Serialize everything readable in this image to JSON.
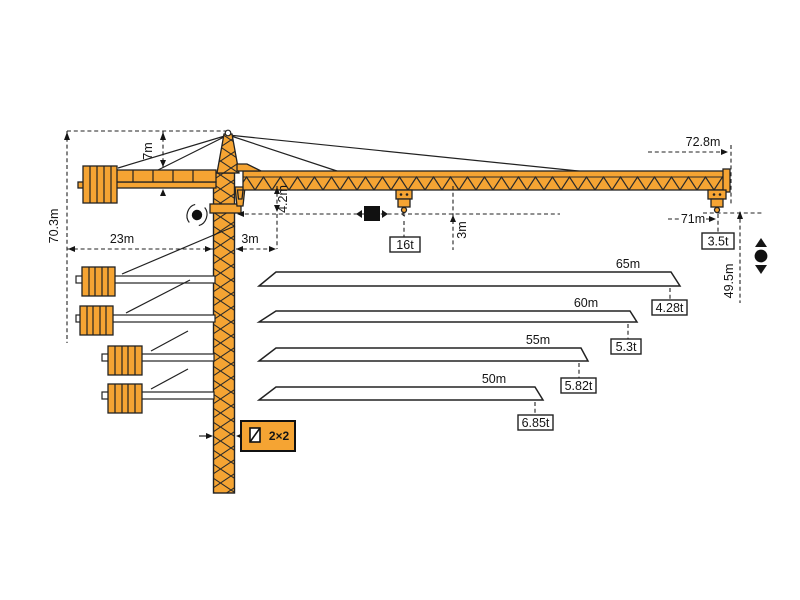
{
  "diagram": {
    "type": "tower-crane-specification-drawing",
    "colors": {
      "crane_orange": "#F5A433",
      "line_black": "#222222",
      "background": "#ffffff"
    },
    "dims": {
      "total_height": "70.3m",
      "head_height": "7m",
      "counterjib_radius": "23m",
      "slew_offset": "3m",
      "jib_depth": "4.2m",
      "hook_drop": "3m",
      "max_capacity": "16t",
      "jib_length_overall": "72.8m",
      "max_hook_radius": "71m",
      "tip_capacity": "3.5t",
      "hook_height": "49.5m",
      "mast_section": "2×2"
    },
    "variants": [
      {
        "length": "65m",
        "tip_capacity": "4.28t"
      },
      {
        "length": "60m",
        "tip_capacity": "5.3t"
      },
      {
        "length": "55m",
        "tip_capacity": "5.82t"
      },
      {
        "length": "50m",
        "tip_capacity": "6.85t"
      }
    ]
  }
}
